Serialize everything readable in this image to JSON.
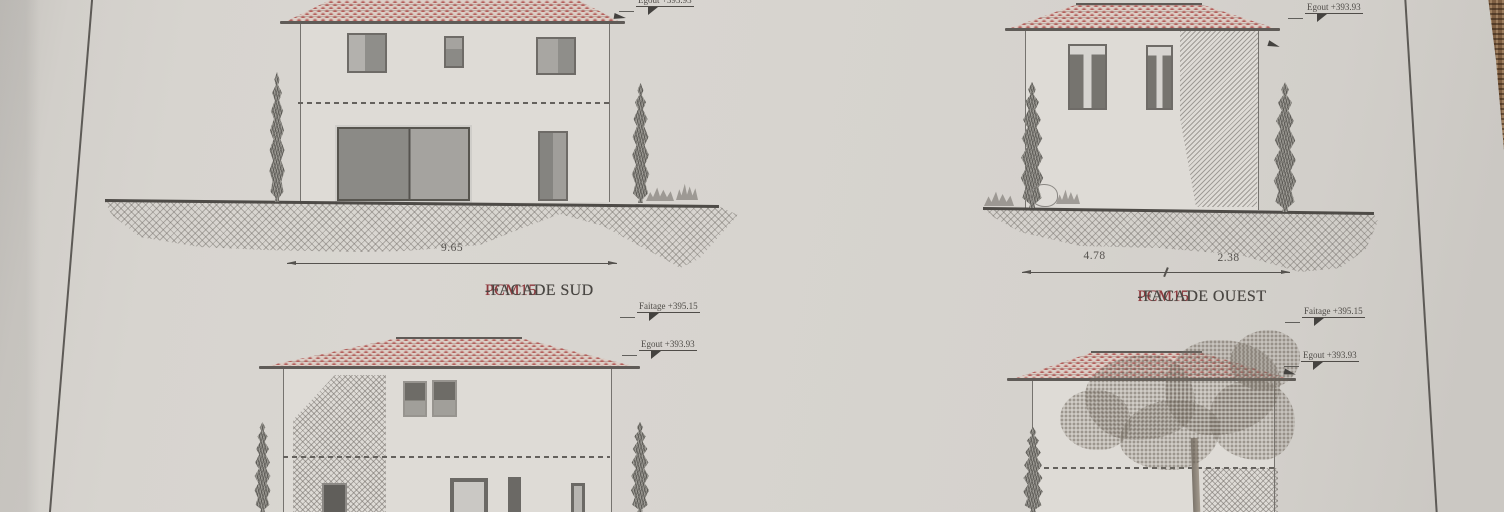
{
  "captions": {
    "top_left": {
      "prefix": "PCM15",
      "rest": "-FACADE SUD"
    },
    "top_right": {
      "prefix": "PCM15",
      "rest": "-FACADE OUEST"
    }
  },
  "dimensions": {
    "top_left_width": "9.65",
    "top_right_left": "4.78",
    "top_right_right": "2.38"
  },
  "levels": {
    "faitage": "Faitage +395.15",
    "egout": "Egout +393.93"
  },
  "colors": {
    "paper": "#d6d3ce",
    "ink": "#4c4a46",
    "caption_red": "#8e3a3e",
    "roof_tile": "#b45f5c",
    "table_wood": "#7e5f43"
  }
}
